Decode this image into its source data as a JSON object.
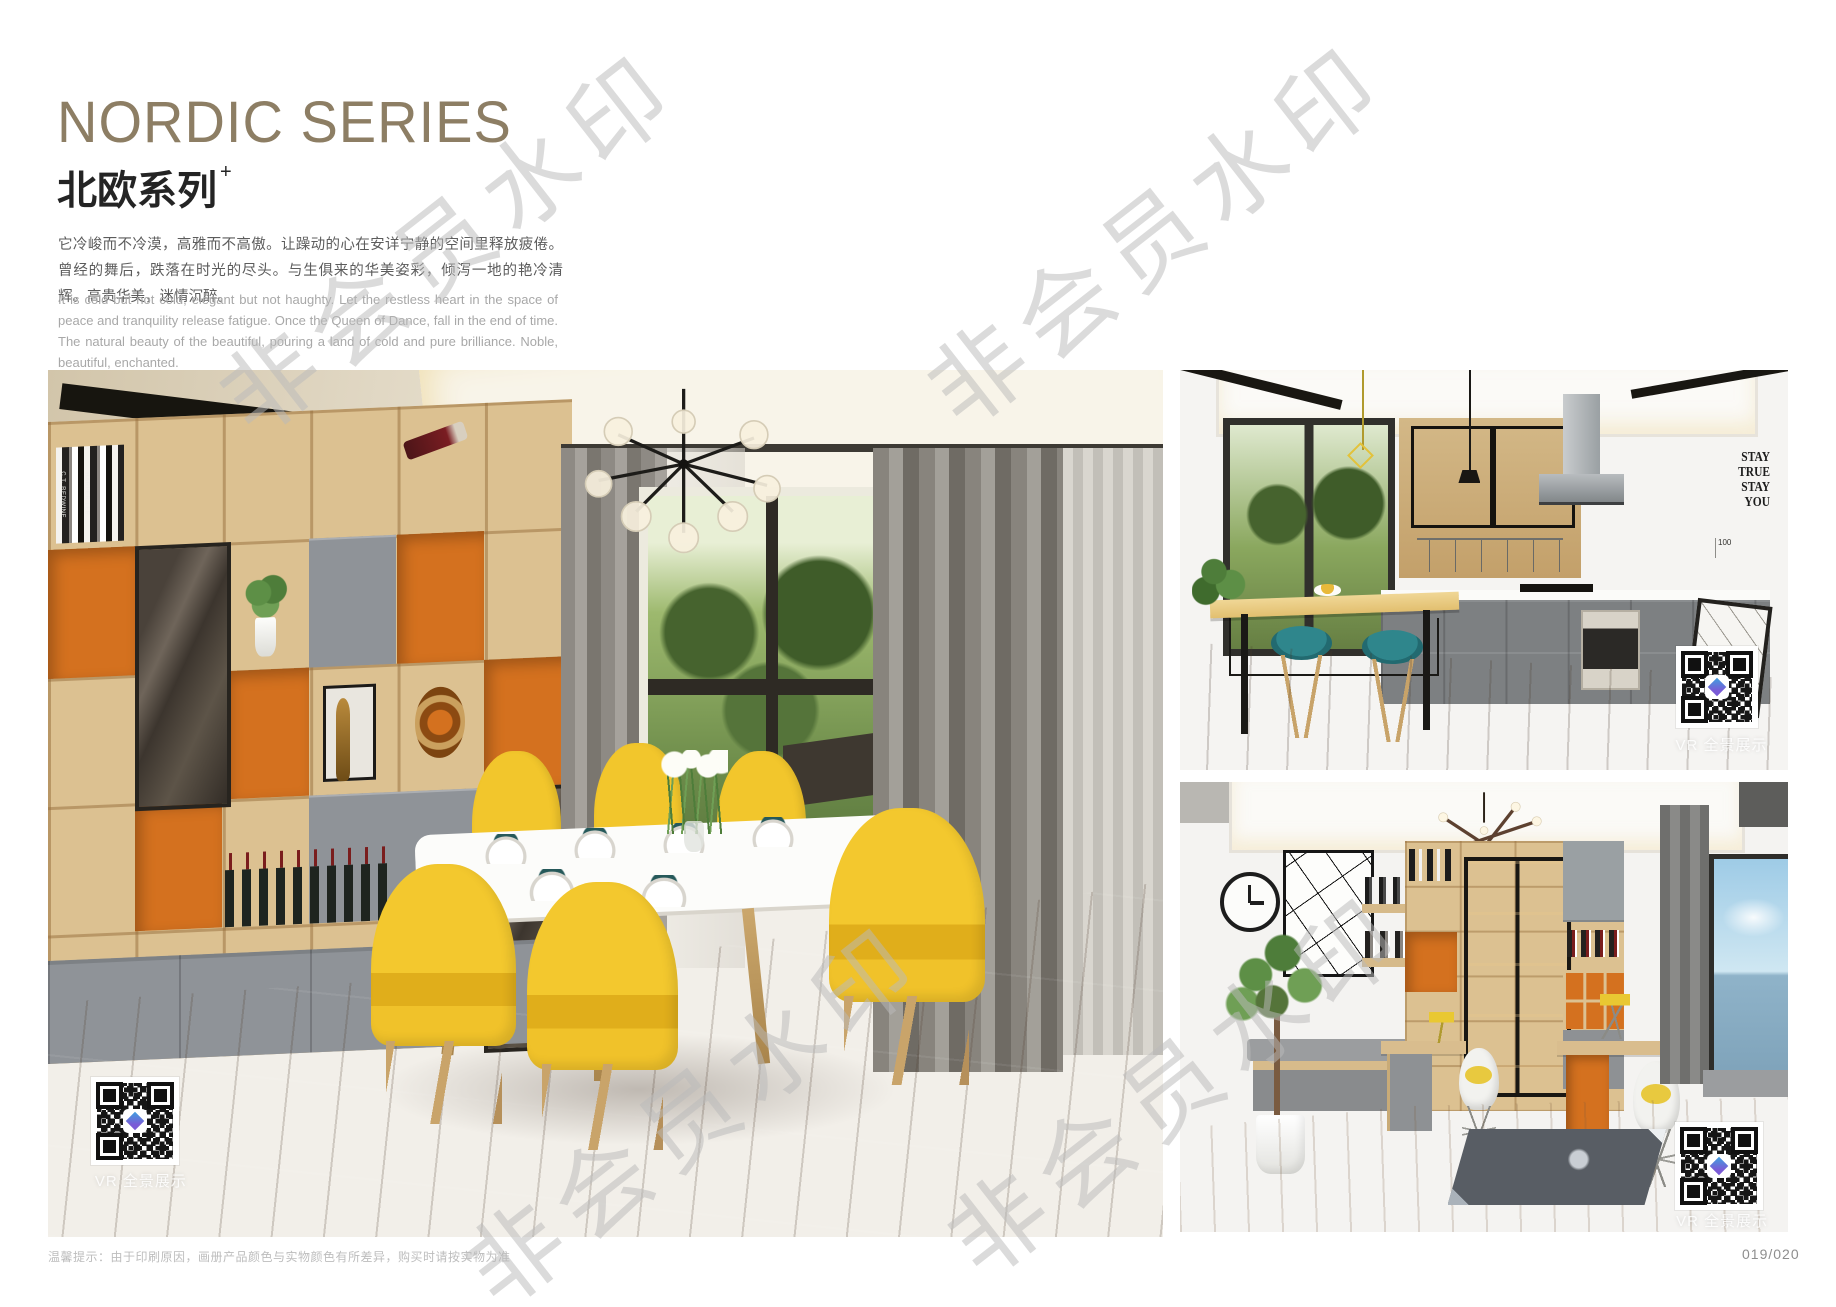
{
  "header": {
    "title": "NORDIC SERIES",
    "subtitle": "北欧系列",
    "subtitle_sup": "+",
    "paragraph_cn": "它冷峻而不冷漠，高雅而不高傲。让躁动的心在安详宁静的空间里释放疲倦。曾经的舞后，跌落在时光的尽头。与生俱来的华美姿彩，倾泻一地的艳冷清辉。高贵华美，迷情沉醉。",
    "paragraph_en": "It is cold but not cold, elegant but not haughty. Let the restless heart in the space of peace and tranquility release fatigue. Once the Queen of Dance, fall in the end of time. The natural beauty of the beautiful, pouring a land of cold and pure brilliance. Noble, beautiful, enchanted."
  },
  "photos": {
    "dining": {
      "vr_label": "VR 全景展示",
      "book_spines": [
        "C.T. REDWINE",
        "HARPER LEE"
      ]
    },
    "kitchen": {
      "vr_label": "VR 全景展示",
      "wall_quote": [
        "STAY",
        "TRUE",
        "STAY",
        "YOU"
      ],
      "ruler_label": "100"
    },
    "study": {
      "vr_label": "VR 全景展示"
    }
  },
  "watermark": {
    "text": "非会员水印"
  },
  "footer": {
    "note": "温馨提示：由于印刷原因，画册产品颜色与实物颜色有所差异，购买时请按实物为准",
    "page_number": "019/020"
  },
  "colors": {
    "title_bronze": "#8d7e64",
    "accent_orange": "#d4711f",
    "chair_yellow": "#f0c32d",
    "stool_teal": "#2b7f86",
    "wood_light": "#dcc191",
    "cabinet_gray": "#8f9398"
  }
}
